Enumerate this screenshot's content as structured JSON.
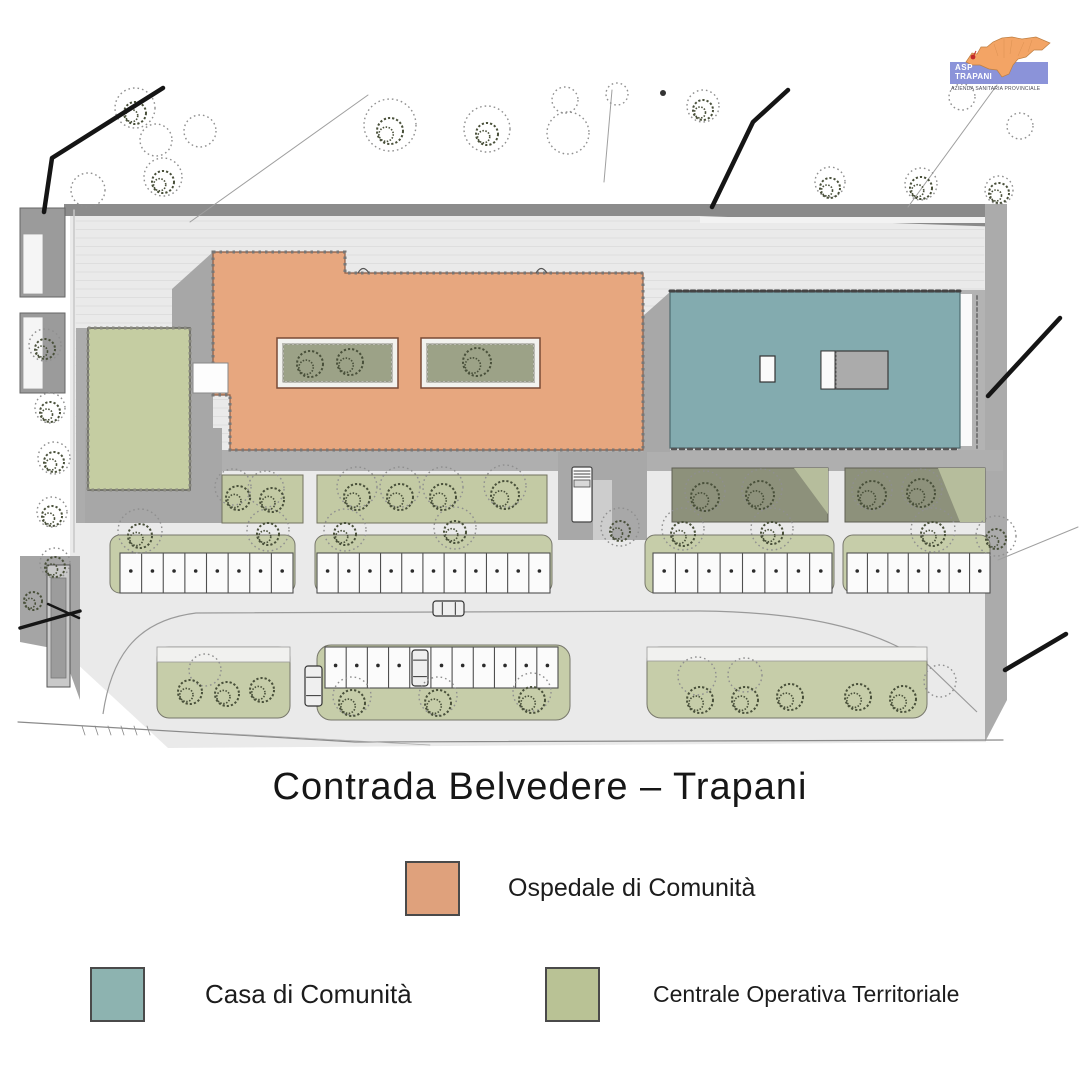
{
  "logo": {
    "org": "ASP",
    "city": "TRAPANI",
    "subtitle": "AZIENDA SANITARIA PROVINCIALE"
  },
  "title": "Contrada Belvedere – Trapani",
  "legend": {
    "items": [
      {
        "id": "ospedale",
        "label": "Ospedale di Comunità",
        "color": "#DFA17C"
      },
      {
        "id": "casa",
        "label": "Casa di Comunità",
        "color": "#8DB3B0"
      },
      {
        "id": "cot",
        "label": "Centrale Operativa Territoriale",
        "color": "#B9C295"
      }
    ]
  },
  "plan": {
    "colors": {
      "ospedale": "#E7A77F",
      "casa": "#83ABAF",
      "cot": "#C5CDA2",
      "courtyard": "#9CA287",
      "sage": "#C6CDA9",
      "dark_planting": "#8D917B",
      "paved": "#EAEAEA"
    }
  }
}
